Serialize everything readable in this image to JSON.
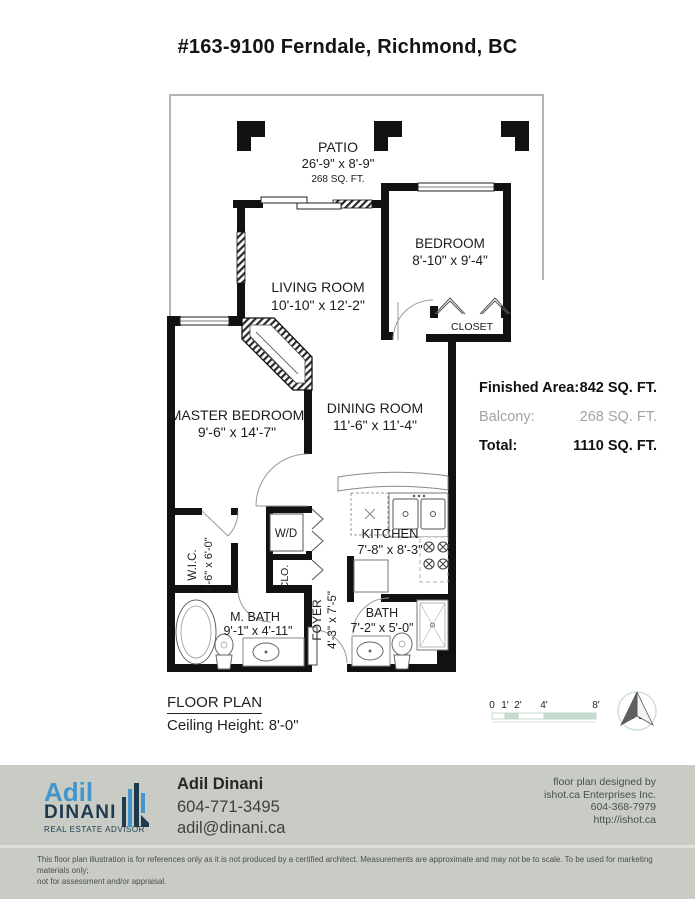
{
  "title": "#163-9100 Ferndale, Richmond, BC",
  "rooms": {
    "patio": {
      "name": "PATIO",
      "dims": "26'-9\" x 8'-9\"",
      "area": "268 SQ. FT."
    },
    "bedroom": {
      "name": "BEDROOM",
      "dims": "8'-10\" x 9'-4\""
    },
    "closet": {
      "name": "CLOSET"
    },
    "living": {
      "name": "LIVING ROOM",
      "dims": "10'-10\" x 12'-2\""
    },
    "master": {
      "name": "MASTER BEDROOM",
      "dims": "9'-6\" x 14'-7\""
    },
    "dining": {
      "name": "DINING ROOM",
      "dims": "11'-6\" x 11'-4\""
    },
    "kitchen": {
      "name": "KITCHEN",
      "dims": "7'-8\" x 8'-3\""
    },
    "wic": {
      "name": "W.I.C.",
      "dims": "4'-6\" x 6'-0\""
    },
    "wd": {
      "name": "W/D"
    },
    "clo": {
      "name": "CLO."
    },
    "mbath": {
      "name": "M. BATH",
      "dims": "9'-1\" x 4'-11\""
    },
    "foyer": {
      "name": "FOYER",
      "dims": "4'-3\" x 7'-5\""
    },
    "bath": {
      "name": "BATH",
      "dims": "7'-2\" x 5'-0\""
    }
  },
  "areas": {
    "finished_label": "Finished Area:",
    "finished_value": "842 SQ. FT.",
    "balcony_label": "Balcony:",
    "balcony_value": "268 SQ. FT.",
    "total_label": "Total:",
    "total_value": "1110 SQ. FT."
  },
  "plan_meta": {
    "floor_plan_label": "FLOOR PLAN",
    "ceiling_height": "Ceiling Height: 8'-0\""
  },
  "scale_bar": {
    "ticks": [
      "0",
      "1'",
      "2'",
      "4'",
      "8'"
    ]
  },
  "compass": {
    "north_label": "N"
  },
  "footer": {
    "logo": {
      "first": "Adil",
      "last": "DINANI",
      "tagline": "REAL ESTATE ADVISOR"
    },
    "agent": {
      "name": "Adil Dinani",
      "phone": "604-771-3495",
      "email": "adil@dinani.ca"
    },
    "designer": {
      "line1": "floor plan designed by",
      "line2": "ishot.ca Enterprises Inc.",
      "line3": "604-368-7979",
      "line4": "http://ishot.ca"
    },
    "disclaimer_line1": "This floor plan illustration is for references only as it is not produced by a certified architect. Measurements are approximate and may not be to scale. To be used for marketing materials only;",
    "disclaimer_line2": "not for assessment and/or appraisal."
  },
  "colors": {
    "wall": "#111111",
    "scale_green": "#c6ddce",
    "logo_blue": "#4496ca",
    "logo_navy": "#1e3a50",
    "footer_bg": "#c8ccc5"
  }
}
